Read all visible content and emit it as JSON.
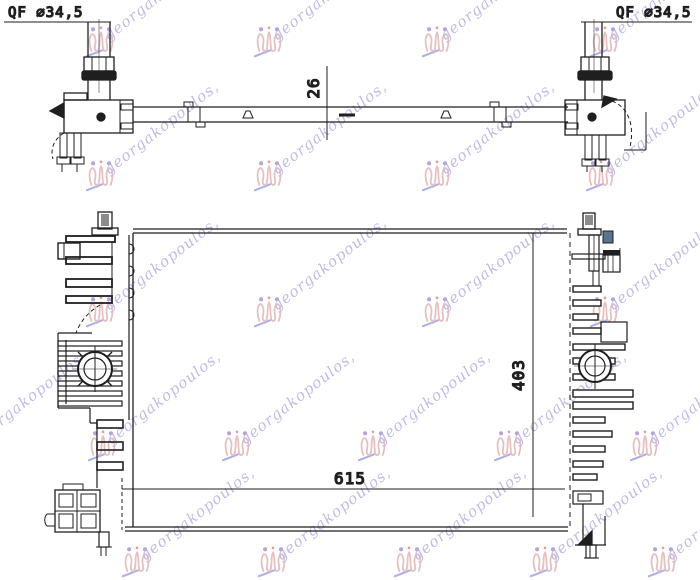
{
  "page": {
    "background": "#ffffff",
    "ink_color": "#1f1f1f"
  },
  "labels": {
    "fitting_left": "QF ∅34,5",
    "fitting_right": "QF ∅34,5"
  },
  "dimensions": {
    "depth_mm": "26",
    "width_mm": "615",
    "height_mm": "403"
  },
  "watermark": {
    "text": "georgakopoulos,",
    "text_color": "#8d85d6",
    "crest_color": "#d28b8b",
    "dot_color": "#7e57c9",
    "accent_dot_color": "#cf4a4a",
    "underline_color": "#7070d8",
    "opacity": 0.55,
    "positions": [
      {
        "x": 86,
        "y": 16
      },
      {
        "x": 254,
        "y": 16
      },
      {
        "x": 422,
        "y": 16
      },
      {
        "x": 590,
        "y": 16
      },
      {
        "x": 86,
        "y": 150
      },
      {
        "x": 254,
        "y": 150
      },
      {
        "x": 422,
        "y": 150
      },
      {
        "x": 586,
        "y": 150
      },
      {
        "x": 86,
        "y": 286
      },
      {
        "x": 254,
        "y": 286
      },
      {
        "x": 422,
        "y": 286
      },
      {
        "x": 590,
        "y": 286
      },
      {
        "x": -46,
        "y": 420
      },
      {
        "x": 88,
        "y": 420
      },
      {
        "x": 222,
        "y": 420
      },
      {
        "x": 358,
        "y": 420
      },
      {
        "x": 494,
        "y": 420
      },
      {
        "x": 630,
        "y": 420
      },
      {
        "x": 122,
        "y": 536
      },
      {
        "x": 258,
        "y": 536
      },
      {
        "x": 394,
        "y": 536
      },
      {
        "x": 530,
        "y": 536
      },
      {
        "x": 648,
        "y": 536
      }
    ]
  }
}
